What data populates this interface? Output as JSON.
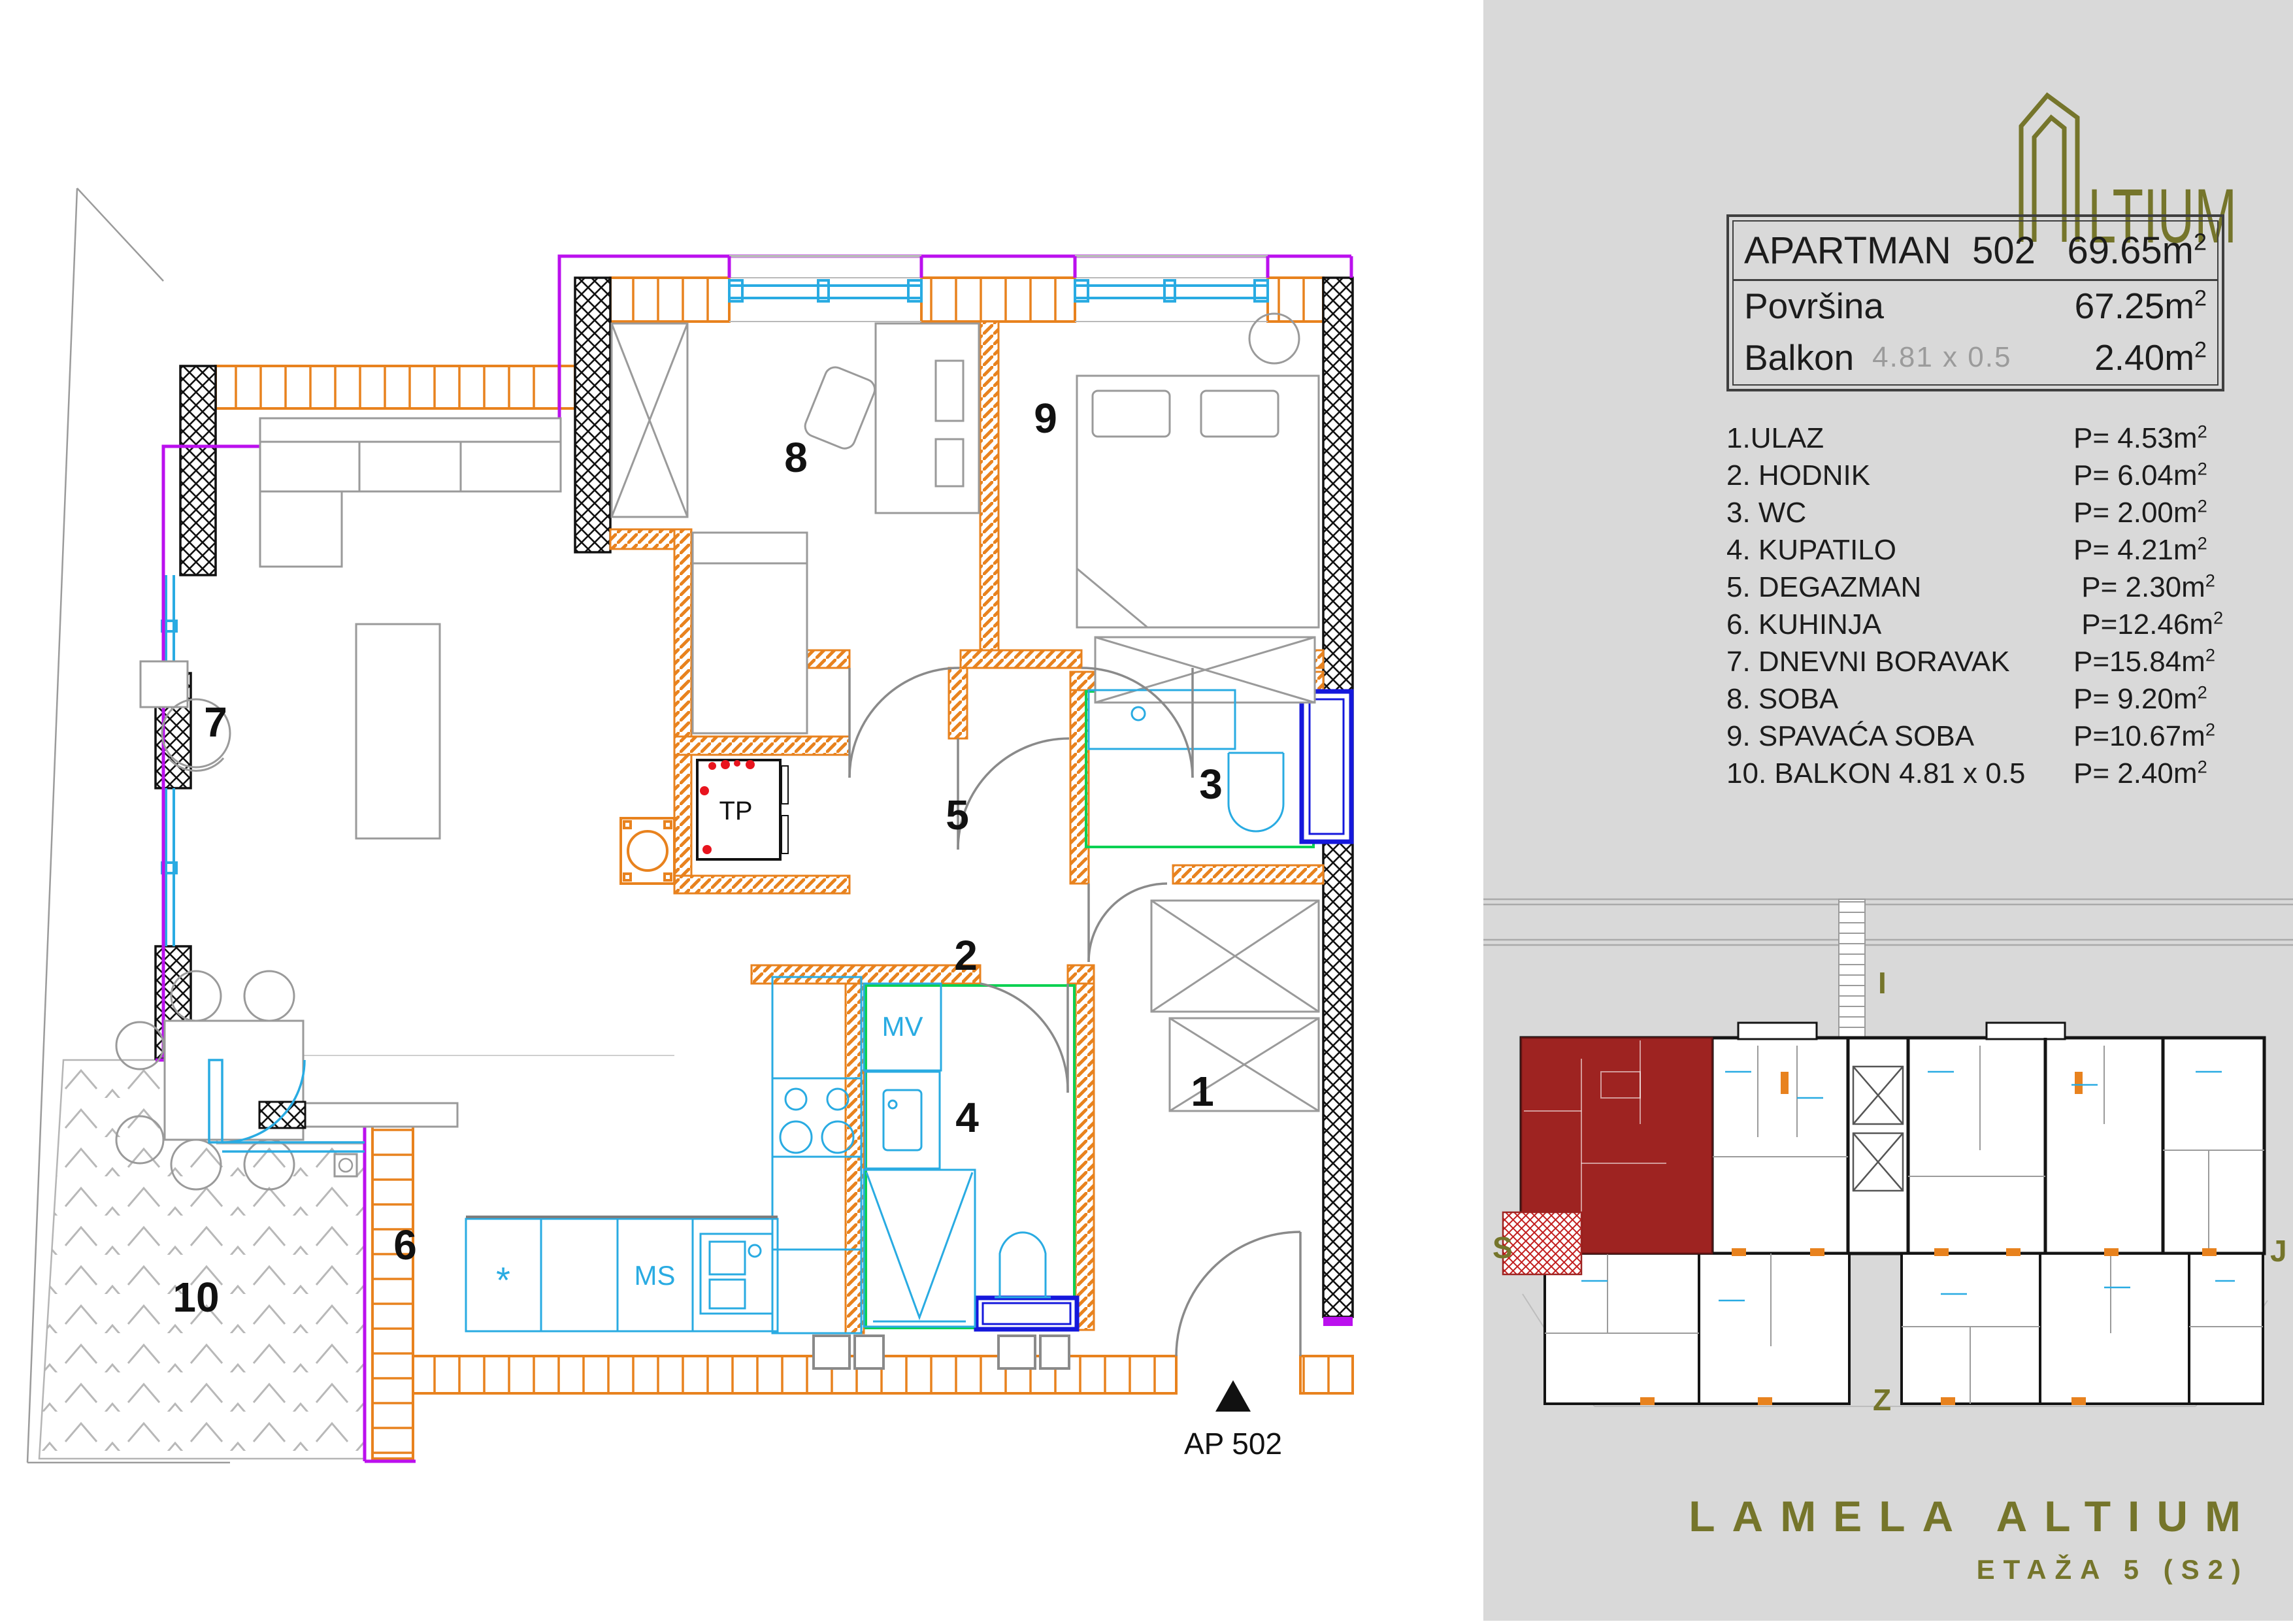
{
  "colors": {
    "sidebar_bg": "#d9d9d9",
    "brand_olive": "#75752b",
    "wall_orange": "#E8821E",
    "window_cyan": "#29abe2",
    "boundary_magenta": "#bb10ee",
    "highlight_red": "#9e2321",
    "accent_green": "#0bd152",
    "frame_blue": "#1518dc",
    "dot_red": "#e8141e"
  },
  "sidebar": {
    "logo": {
      "glyph": "altium-building-monogram",
      "text": "LTIUM"
    },
    "info_table": {
      "sup": "2",
      "rows": [
        {
          "label": "APARTMAN  502",
          "value": "69.65m"
        },
        {
          "label": "Površina",
          "value": "67.25m"
        },
        {
          "label": "Balkon",
          "note": "4.81 x 0.5",
          "value": "2.40m"
        }
      ]
    },
    "rooms": [
      {
        "label": "1.ULAZ",
        "area": "P= 4.53m"
      },
      {
        "label": "2. HODNIK",
        "area": "P= 6.04m"
      },
      {
        "label": "3. WC",
        "area": "P= 2.00m"
      },
      {
        "label": "4. KUPATILO",
        "area": "P= 4.21m"
      },
      {
        "label": "5. DEGAZMAN",
        "area": " P= 2.30m"
      },
      {
        "label": "6. KUHINJA",
        "area": " P=12.46m"
      },
      {
        "label": "7. DNEVNI BORAVAK",
        "area": "P=15.84m"
      },
      {
        "label": "8. SOBA",
        "area": "P= 9.20m"
      },
      {
        "label": "9. SPAVAĆA SOBA",
        "area": "P=10.67m"
      },
      {
        "label": "10. BALKON 4.81 x 0.5",
        "area": "P= 2.40m"
      }
    ],
    "minimap": {
      "compass": {
        "top": "I",
        "left": "S",
        "right": "J",
        "bottom": "Z"
      }
    },
    "project_title": "LAMELA ALTIUM",
    "project_subtitle": "ETAŽA 5 (S2)"
  },
  "plan": {
    "unit_marker": "AP 502",
    "labels": {
      "r1": "1",
      "r2": "2",
      "r3": "3",
      "r4": "4",
      "r5": "5",
      "r6": "6",
      "r7": "7",
      "r8": "8",
      "r9": "9",
      "r10": "10"
    },
    "equipment": {
      "tp": "TP",
      "mv": "MV",
      "ms": "MS",
      "star": "*"
    }
  }
}
